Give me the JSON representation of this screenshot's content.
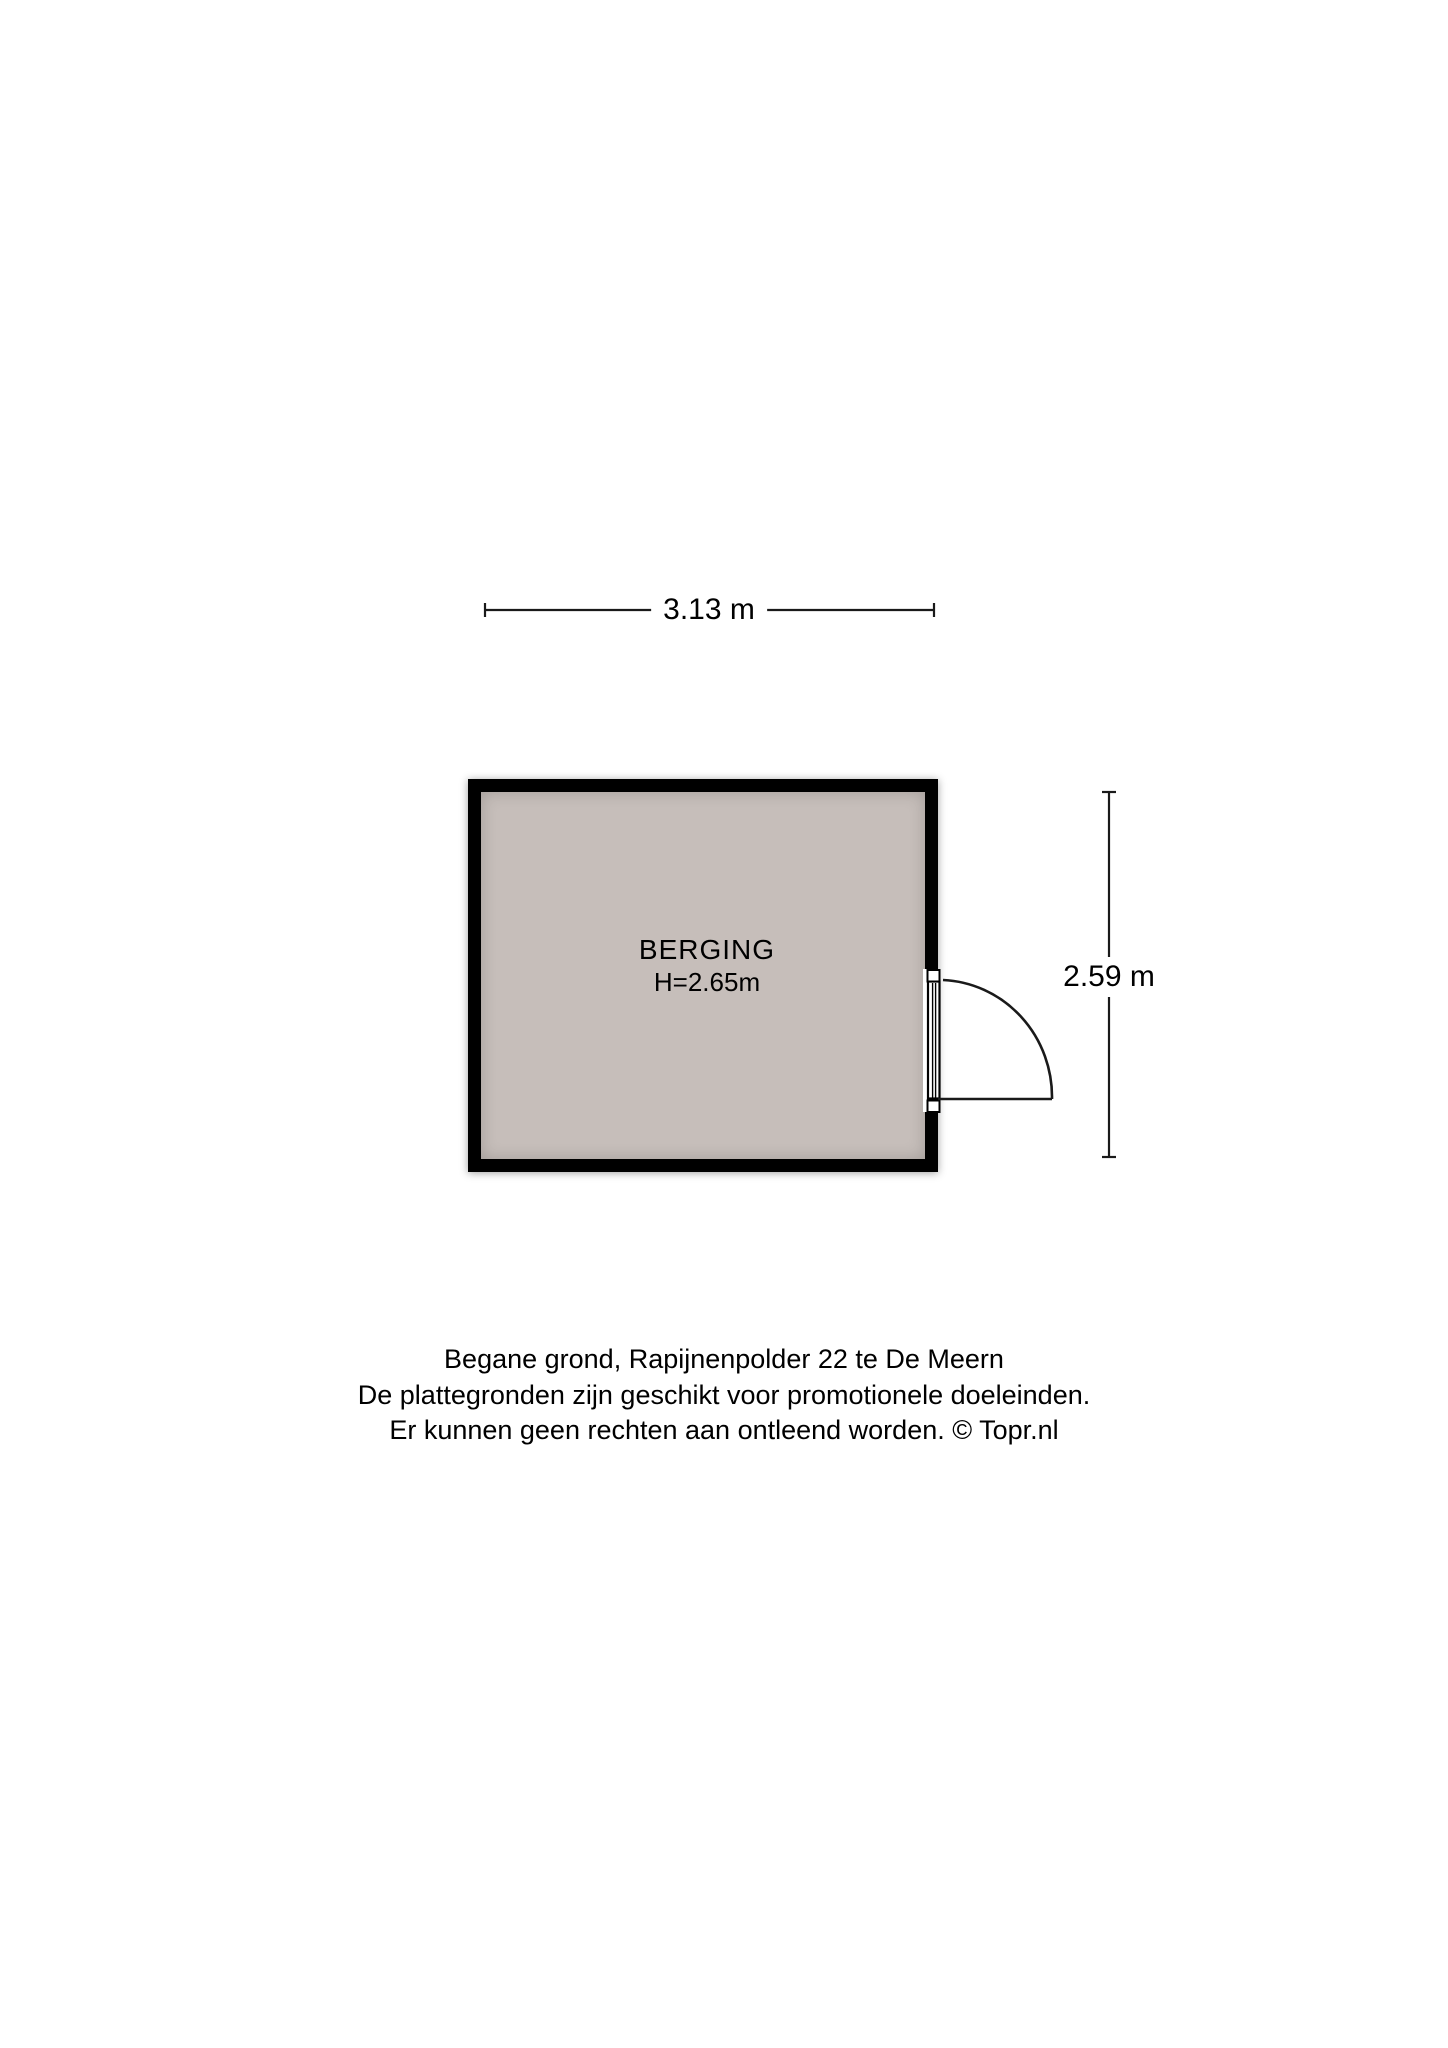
{
  "floorplan": {
    "room": {
      "name": "BERGING",
      "ceiling_height": "H=2.65m"
    },
    "dimensions": {
      "width_label": "3.13 m",
      "height_label": "2.59 m"
    },
    "caption": {
      "lines": [
        "Begane grond, Rapijnenpolder 22 te De Meern",
        "De plattegronden zijn geschikt voor promotionele doeleinden.",
        "Er kunnen geen rechten aan ontleend worden. © Topr.nl"
      ]
    },
    "colors": {
      "background": "#ffffff",
      "wall": "#000000",
      "floor_fill": "#c6beba",
      "line": "#1a1a1a"
    }
  }
}
